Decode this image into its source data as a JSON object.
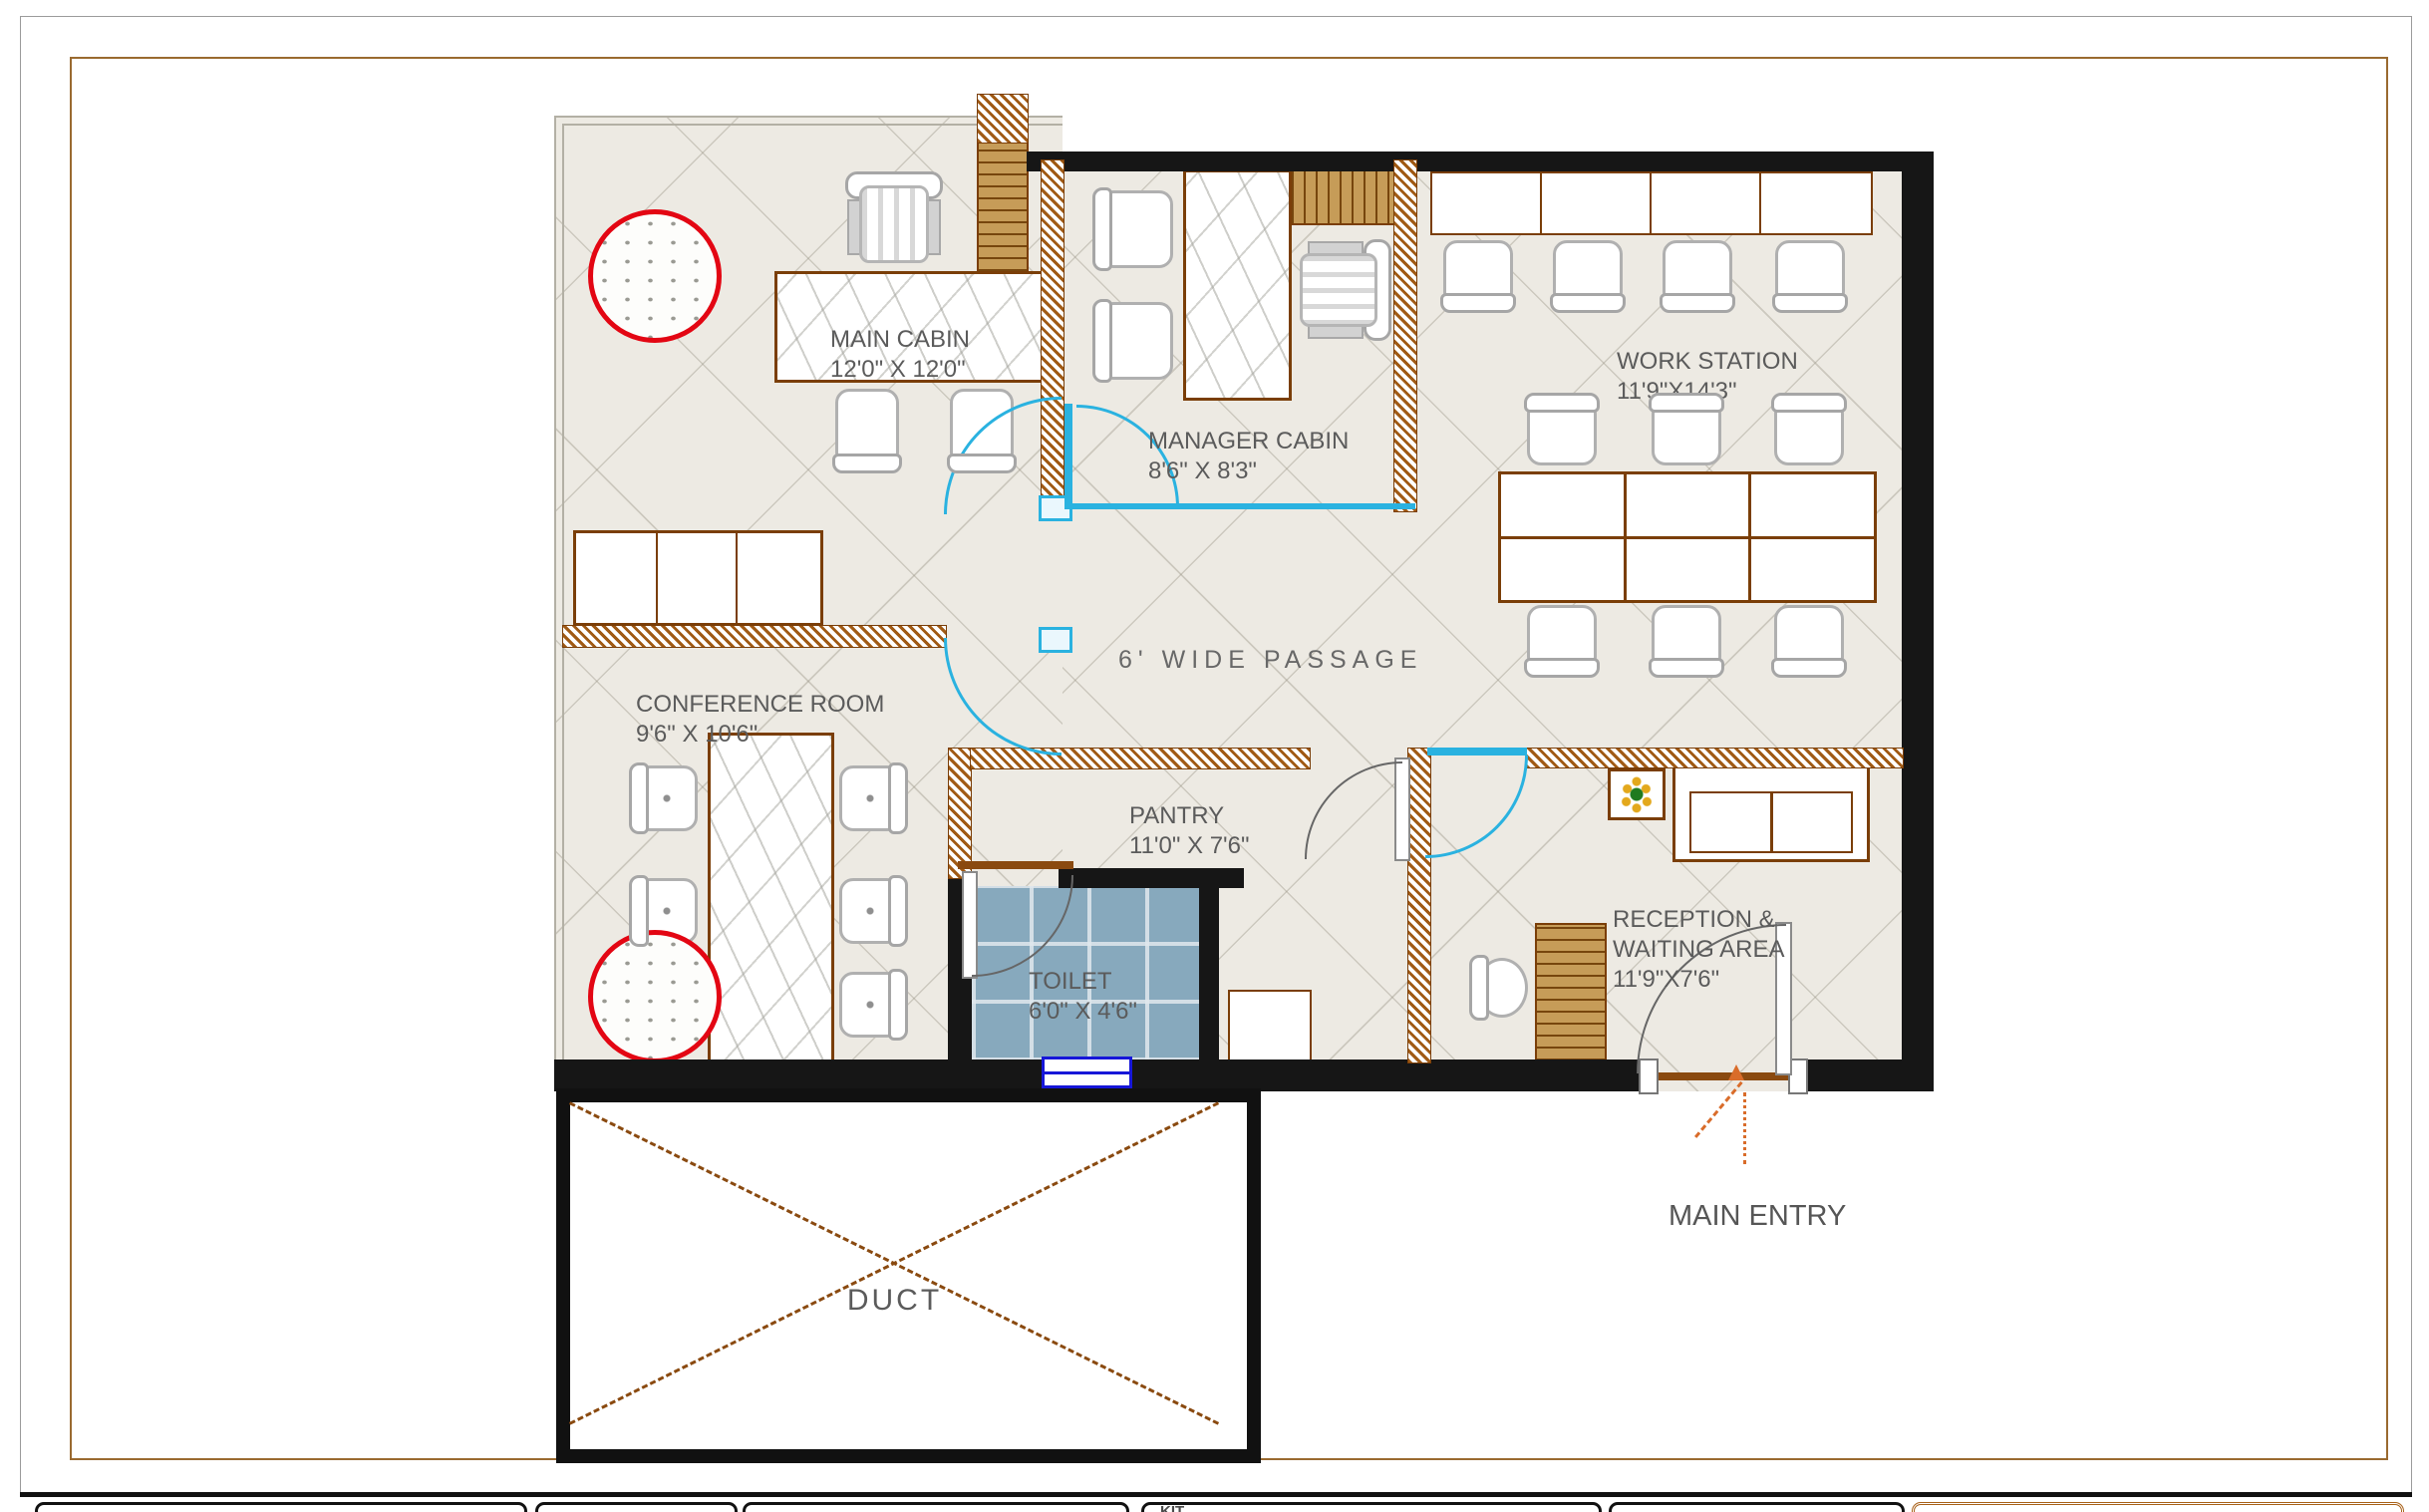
{
  "document": {
    "type": "office-floor-plan"
  },
  "colors": {
    "floor": "#edeae3",
    "frame_brown": "#9a6a30",
    "wall_brown": "#8a4a10",
    "wall_dark": "#161616",
    "door_cyan": "#2ab2e0",
    "tile_blue": "#87a9bd",
    "accent_red": "#e30613",
    "arrow_orange": "#d96c2a",
    "wood": "#c69c58",
    "label_gray": "#5b5b5b"
  },
  "rooms": {
    "main_cabin": {
      "name": "MAIN CABIN",
      "dims": "12'0\" X 12'0\""
    },
    "manager_cabin": {
      "name": "MANAGER CABIN",
      "dims": "8'6\" X 8'3\""
    },
    "work_station": {
      "name": "WORK STATION",
      "dims": "11'9\"X14'3\""
    },
    "conference_room": {
      "name": "CONFERENCE ROOM",
      "dims": "9'6\" X 10'6\""
    },
    "passage": {
      "name": "6' WIDE PASSAGE"
    },
    "pantry": {
      "name": "PANTRY",
      "dims": "11'0\" X 7'6\""
    },
    "toilet": {
      "name": "TOILET",
      "dims": "6'0\" X 4'6\""
    },
    "reception": {
      "name": "RECEPTION &\nWAITING AREA",
      "dims": "11'9\"X7'6\""
    },
    "duct": {
      "name": "DUCT"
    }
  },
  "annotations": {
    "main_entry": "MAIN ENTRY"
  },
  "title_block": {
    "partial_text": "KIT"
  }
}
